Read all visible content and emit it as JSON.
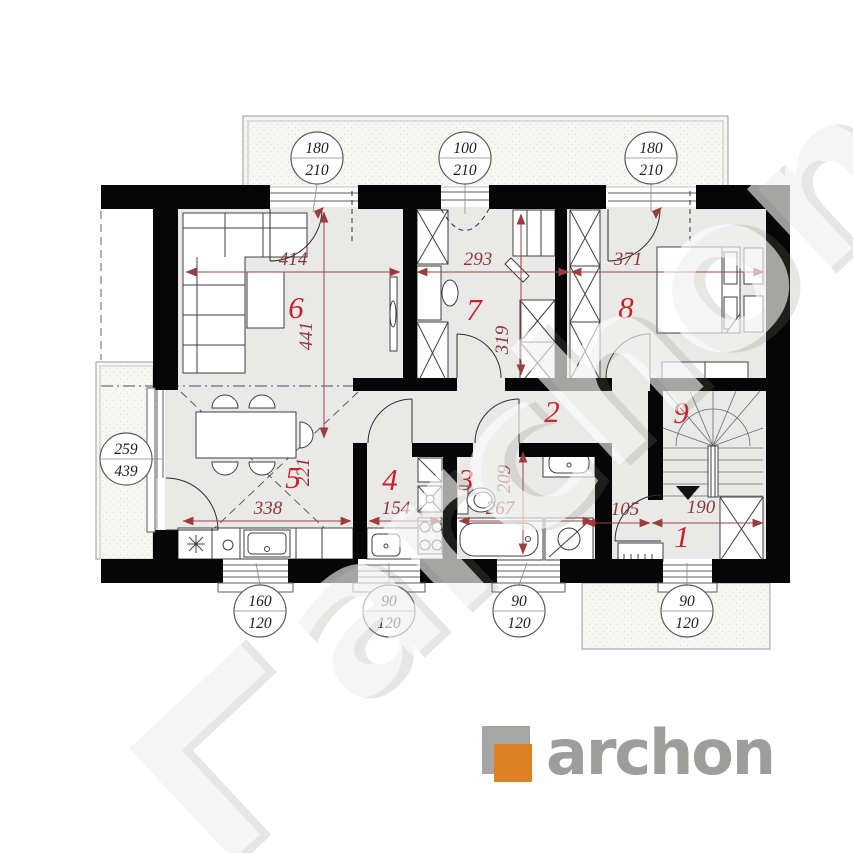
{
  "branding": {
    "logo_text": "archon",
    "watermark_text": "archon",
    "logo_orange": "#dd8124",
    "logo_gray": "#9d9d9c"
  },
  "rooms": {
    "r1": "1",
    "r2": "2",
    "r3": "3",
    "r4": "4",
    "r5": "5",
    "r6": "6",
    "r7": "7",
    "r8": "8",
    "r9": "9"
  },
  "dimensions": {
    "d414": "414",
    "d441": "441",
    "d293": "293",
    "d319": "319",
    "d371": "371",
    "d338": "338",
    "d221": "221",
    "d154": "154",
    "d267": "267",
    "d209": "209",
    "d105": "105",
    "d190": "190"
  },
  "window_tags": {
    "top": [
      {
        "w": "180",
        "h": "210"
      },
      {
        "w": "100",
        "h": "210"
      },
      {
        "w": "180",
        "h": "210"
      }
    ],
    "left": [
      {
        "w": "259",
        "h": "439"
      }
    ],
    "bottom": [
      {
        "w": "160",
        "h": "120"
      },
      {
        "w": "90",
        "h": "120"
      },
      {
        "w": "90",
        "h": "120"
      },
      {
        "w": "90",
        "h": "120"
      }
    ]
  },
  "colors": {
    "wall": "#060606",
    "floor_fill": "#e9e9e8",
    "terrace_fill": "#f6f6f3",
    "dim_line": "#9b4343",
    "dim_text": "#8e3535",
    "room_number": "#cb2129",
    "furniture_line": "#3f3f3f"
  }
}
